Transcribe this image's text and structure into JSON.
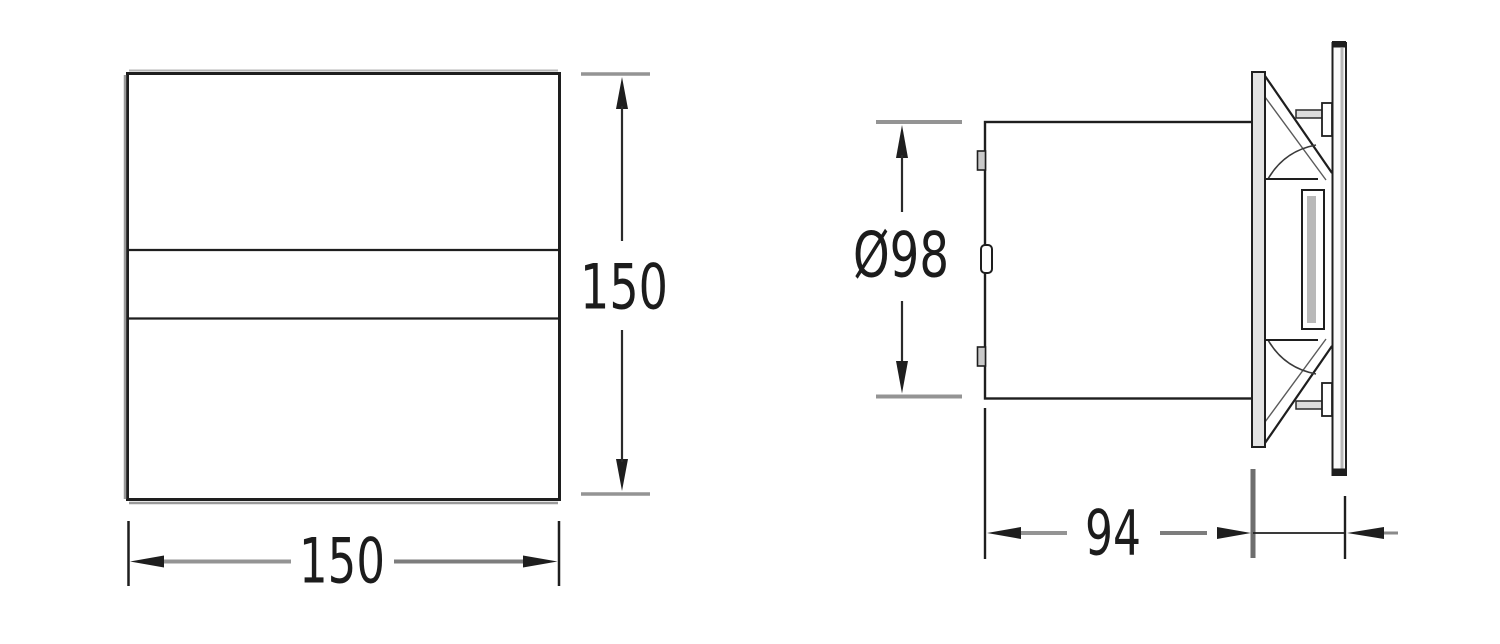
{
  "drawing": {
    "kind": "technical-dimension-drawing",
    "subject": "extractor fan — front view and side view with dimensions",
    "front_view": {
      "height_label": "150",
      "width_label": "150"
    },
    "side_view": {
      "diameter_label": "Ø98",
      "depth_label": "94"
    },
    "colors": {
      "line": "#1e1e1e",
      "dim_gray": "#949494",
      "plate_fill": "#e2e2e2",
      "background": "#ffffff"
    }
  }
}
